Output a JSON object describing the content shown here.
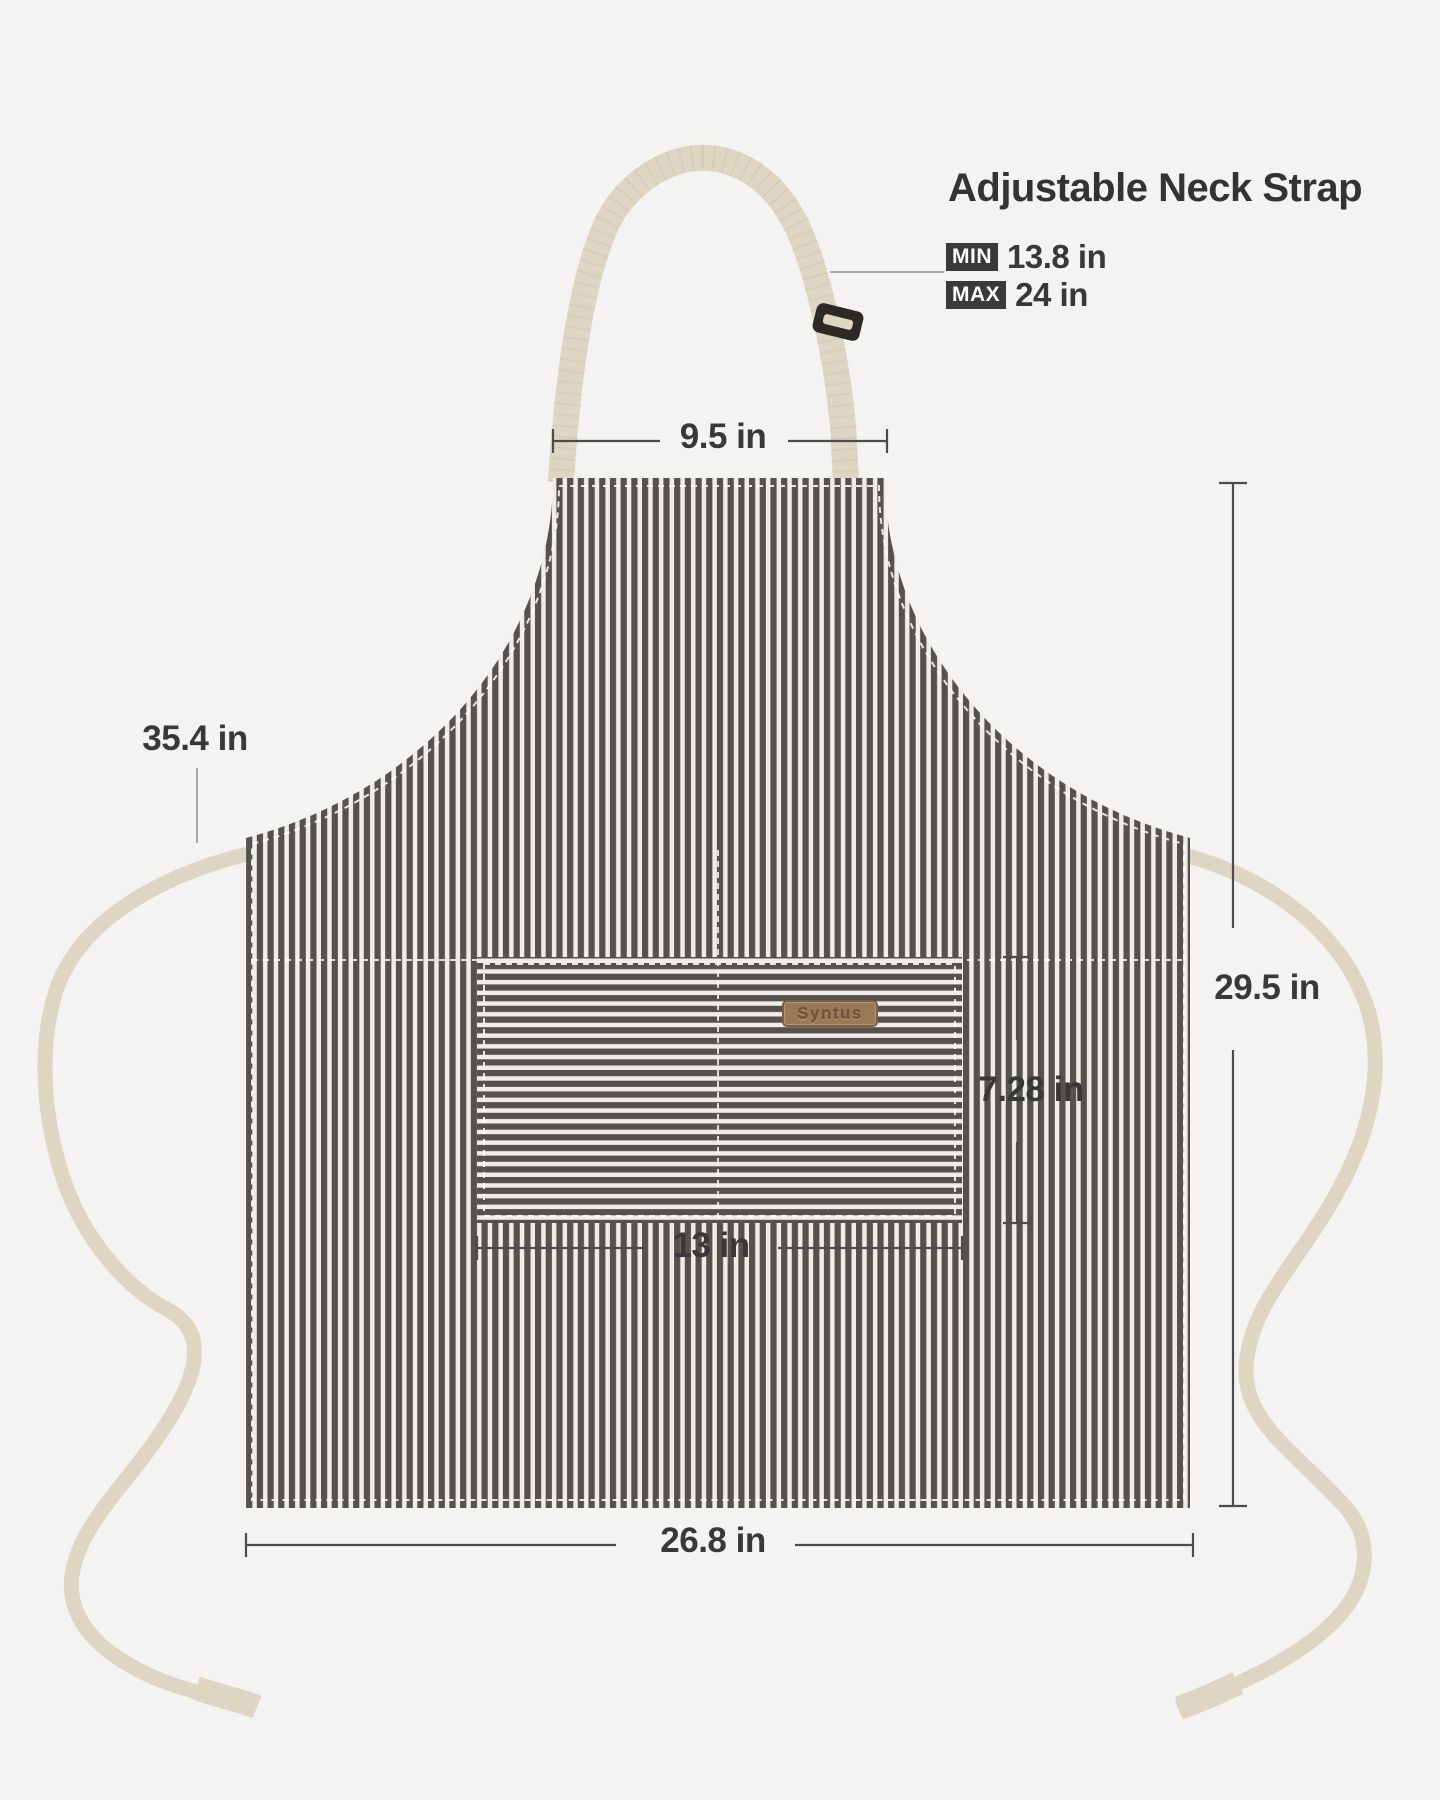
{
  "title": "Adjustable Neck Strap",
  "neck_strap": {
    "min_badge": "MIN",
    "min_value": "13.8 in",
    "max_badge": "MAX",
    "max_value": "24 in"
  },
  "brand_label": "Syntus",
  "dimensions": {
    "neck_width": "9.5 in",
    "tie_length": "35.4 in",
    "height": "29.5 in",
    "pocket_height": "7.28 in",
    "pocket_width": "13 in",
    "width": "26.8 in"
  },
  "colors": {
    "page-bg": "#f4f3f1",
    "stripe-dark": "#56514b",
    "stripe-light": "#efede8",
    "strap": "#ded6c2",
    "strap-edge": "#c3b99e",
    "buckle": "#2d2a25",
    "label-bg": "#9a7a56",
    "label-border": "#7c5f41",
    "label-text": "#6f5538",
    "dim-line": "#4c4c4c",
    "text": "#383838",
    "badge-bg": "#3b3a38",
    "badge-text": "#ffffff",
    "stitch": "#ffffff"
  }
}
